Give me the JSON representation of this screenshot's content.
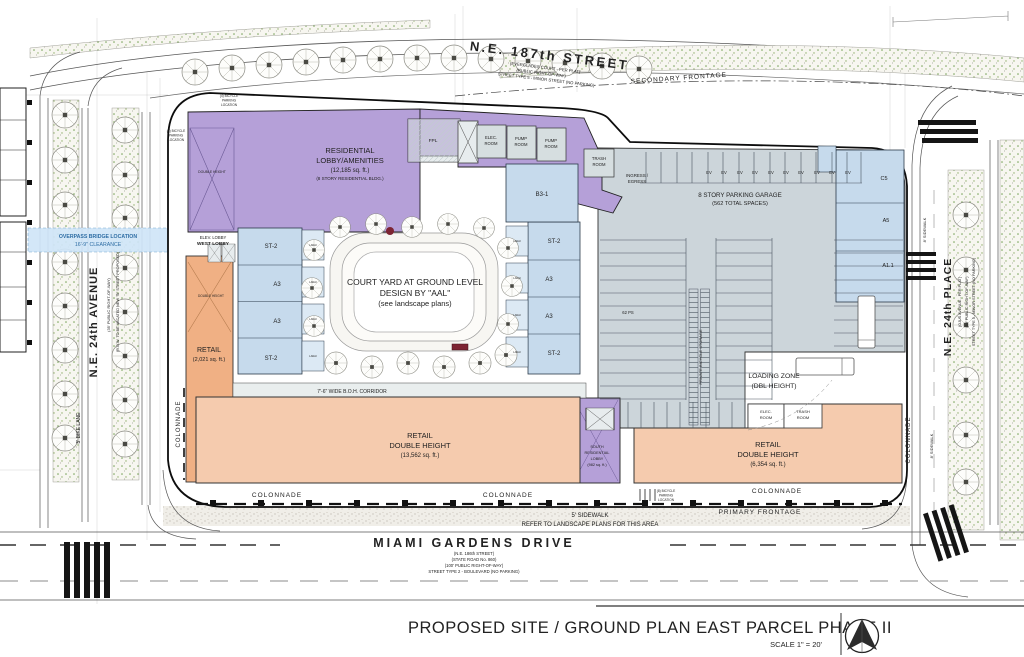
{
  "colors": {
    "residential_purple": "#b5a0d8",
    "unit_blue": "#c6daec",
    "retail_orange_dark": "#f0b084",
    "retail_salmon": "#f5cbae",
    "garage_gray": "#ccd5da",
    "service_gray": "#d6dee0",
    "overpass_blue": "#cfe5f7",
    "landscape_green": "#76a257",
    "line_dark": "#222222"
  },
  "title_block": {
    "title": "PROPOSED SITE / GROUND  PLAN EAST PARCEL PHASE II",
    "scale": "SCALE  1\" = 20'"
  },
  "streets": {
    "top": {
      "name": "N.E.  187th  STREET",
      "sub1": "(EVERGLADES COURT - PER PLAT)",
      "sub2": "(PUBLIC RIGHT-OF-WAY)",
      "sub3": "STREET TYPE 5 - MINOR STREET (NO PARKING)",
      "frontage": "SECONDARY FRONTAGE"
    },
    "left": {
      "name": "N.E. 24th AVENUE",
      "sub1": "(35' PUBLIC RIGHT-OF-WAY)",
      "sub2": "(R.O.W. TO BE VACATED NEW \"B\" STREET PROPOSED)",
      "bike_lane": "5' BIKE LANE",
      "overpass1": "OVERPASS BRIDGE LOCATION",
      "overpass2": "16'-9\" CLEARANCE"
    },
    "right": {
      "name": "N.E. 24th PLACE",
      "sub1": "(OJUS AVENUE - PER PLAT)",
      "sub2": "(50' PUBLIC RIGHT-OF-WAY)",
      "sub3": "STREET TYPE 5 - MINOR STREET (NO PARKING)",
      "sidewalk": "8' SIDEWALK"
    },
    "bottom": {
      "name": "MIAMI  GARDENS  DRIVE",
      "sub1": "(N.E. 186th STREET)",
      "sub2": "(STATE ROAD No. 860)",
      "sub3": "(100' PUBLIC RIGHT-OF-WAY)",
      "sub4": "STREET TYPE 2 - BOULEVARD (NO PARKING)",
      "sidewalk": "5' SIDEWALK",
      "landscape_note": "REFER TO LANDSCAPE PLANS FOR THIS AREA",
      "frontage": "PRIMARY FRONTAGE"
    }
  },
  "site": {
    "residential_lobby": {
      "l1": "RESIDENTIAL",
      "l2": "LOBBY/AMENITIES",
      "l3": "(12,185 sq. ft.)",
      "l4": "(8 STORY RESIDENTIAL BLDG.)"
    },
    "double_height": "DOUBLE HEIGHT",
    "west_lobby": {
      "l1": "ELEV. LOBBY",
      "l2": "WEST LOBBY"
    },
    "retail_west": {
      "l1": "RETAIL",
      "l2": "(2,021 sq. ft.)"
    },
    "courtyard": {
      "l1": "COURT YARD AT GROUND LEVEL",
      "l2": "DESIGN BY \"AAL\"",
      "l3": "(see landscape plans)"
    },
    "boh": "7'-6\" WIDE B.O.H. CORRIDOR",
    "garage": {
      "l1": "8 STORY PARKING GARAGE",
      "l2": "(562 TOTAL SPACES)",
      "ingress1": "INGRESS /",
      "ingress2": "EGRESS",
      "ev": "EV",
      "ps": "62 PS",
      "bike": "PRIVATE BICYCLE STORAGE",
      "loading1": "LOADING ZONE",
      "loading2": "(DBL HEIGHT)"
    },
    "rooms": {
      "fpl": "FPL",
      "elec1": "ELEC.",
      "elec2": "ROOM",
      "pump1": "PUMP",
      "pump2": "ROOM",
      "trash1": "TRASH",
      "trash2": "ROOM"
    },
    "units": {
      "st2": "ST-2",
      "a3": "A3",
      "b31": "B3-1",
      "c5": "C5",
      "a5": "A5",
      "a11": "A1.1",
      "lanai": "LANAI"
    },
    "south_lobby": {
      "l1": "SOUTH",
      "l2": "RESIDENTIAL",
      "l3": "LOBBY",
      "l4": "(982 sq. ft.)"
    },
    "retail_sw": {
      "l1": "RETAIL",
      "l2": "DOUBLE HEIGHT",
      "l3": "(13,562 sq. ft.)"
    },
    "retail_se": {
      "l1": "RETAIL",
      "l2": "DOUBLE HEIGHT",
      "l3": "(6,354 sq. ft.)"
    },
    "colonnade": "COLONNADE",
    "bike4": {
      "l1": "(4) BICYCLE",
      "l2": "PARKING",
      "l3": "LOCATION"
    },
    "bike8": {
      "l1": "(8) BICYCLE",
      "l2": "PARKING",
      "l3": "LOCATION"
    }
  }
}
